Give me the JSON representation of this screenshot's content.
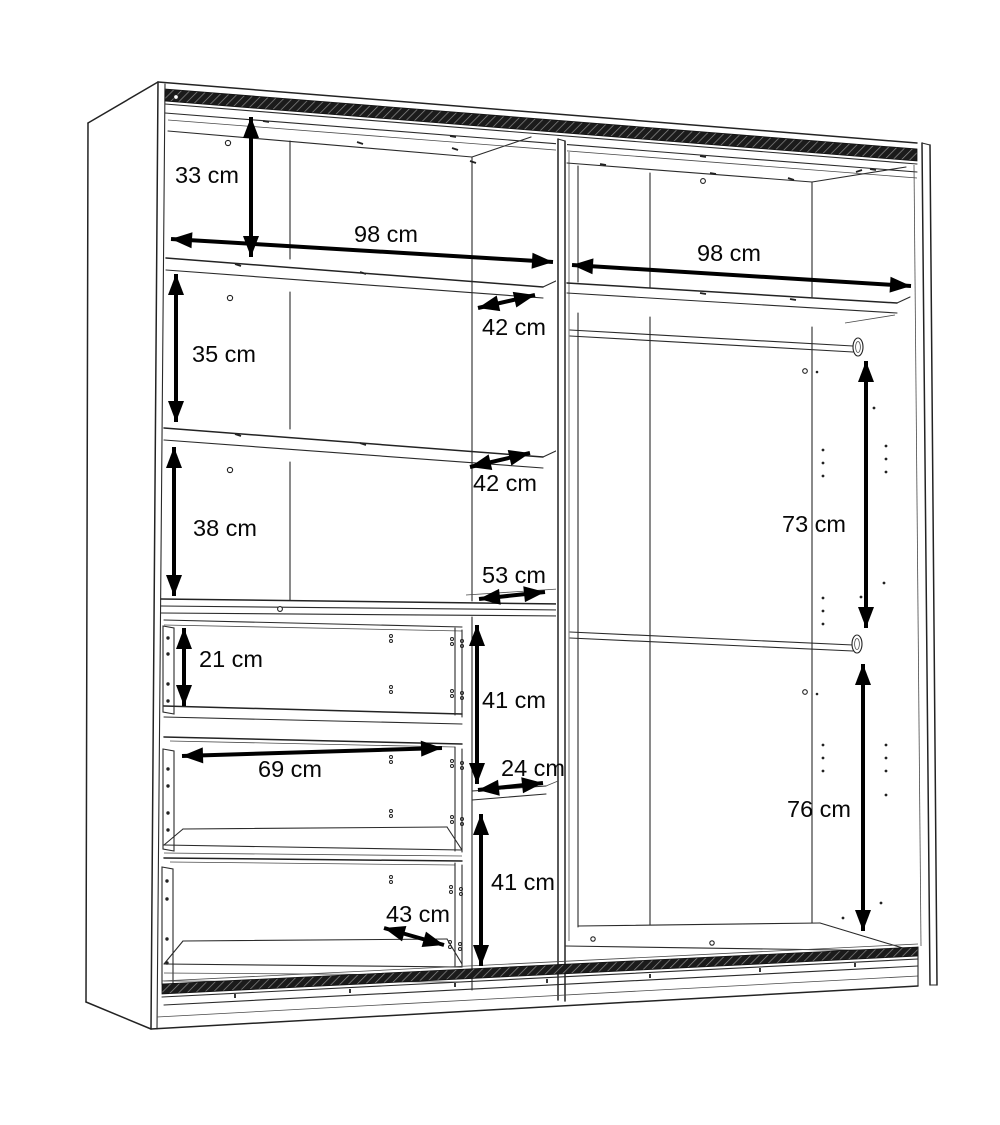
{
  "diagram": {
    "subject": "wardrobe-interior-dimension-diagram",
    "unit": "cm"
  },
  "dims": {
    "d33": "33 cm",
    "d98l": "98 cm",
    "d98r": "98 cm",
    "d42a": "42 cm",
    "d35": "35 cm",
    "d42b": "42 cm",
    "d38": "38 cm",
    "d53": "53 cm",
    "d21": "21 cm",
    "d41a": "41 cm",
    "d69": "69 cm",
    "d24": "24 cm",
    "d41b": "41 cm",
    "d43": "43 cm",
    "d73": "73 cm",
    "d76": "76 cm"
  }
}
